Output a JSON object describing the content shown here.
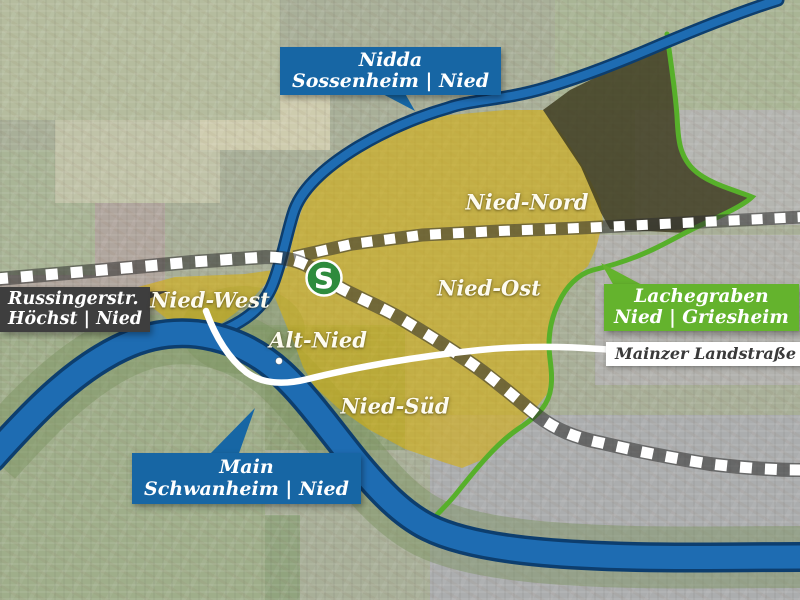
{
  "map": {
    "sbahn_label": "S",
    "districts": [
      {
        "name": "Nied-Nord"
      },
      {
        "name": "Nied-Ost"
      },
      {
        "name": "Nied-West"
      },
      {
        "name": "Alt-Nied"
      },
      {
        "name": "Nied-Süd"
      }
    ],
    "callouts": {
      "nidda": {
        "line1": "Nidda",
        "line2": "Sossenheim | Nied"
      },
      "russingerstrasse": {
        "line1": "Russingerstr.",
        "line2": "Höchst | Nied"
      },
      "lachegraben": {
        "line1": "Lachegraben",
        "line2": "Nied | Griesheim"
      },
      "main_river": {
        "line1": "Main",
        "line2": "Schwanheim | Nied"
      },
      "mainzer_landstrasse": {
        "label": "Mainzer Landstraße"
      }
    },
    "colors": {
      "callout_blue": "#1766a4",
      "callout_dark": "#3e3e3e",
      "callout_green": "#64b32d",
      "boundary_green": "#57b02a",
      "district_yellow": "#d8af0a",
      "river_blue": "#1e6cb2",
      "sbahn_green": "#2e8b3d"
    }
  }
}
